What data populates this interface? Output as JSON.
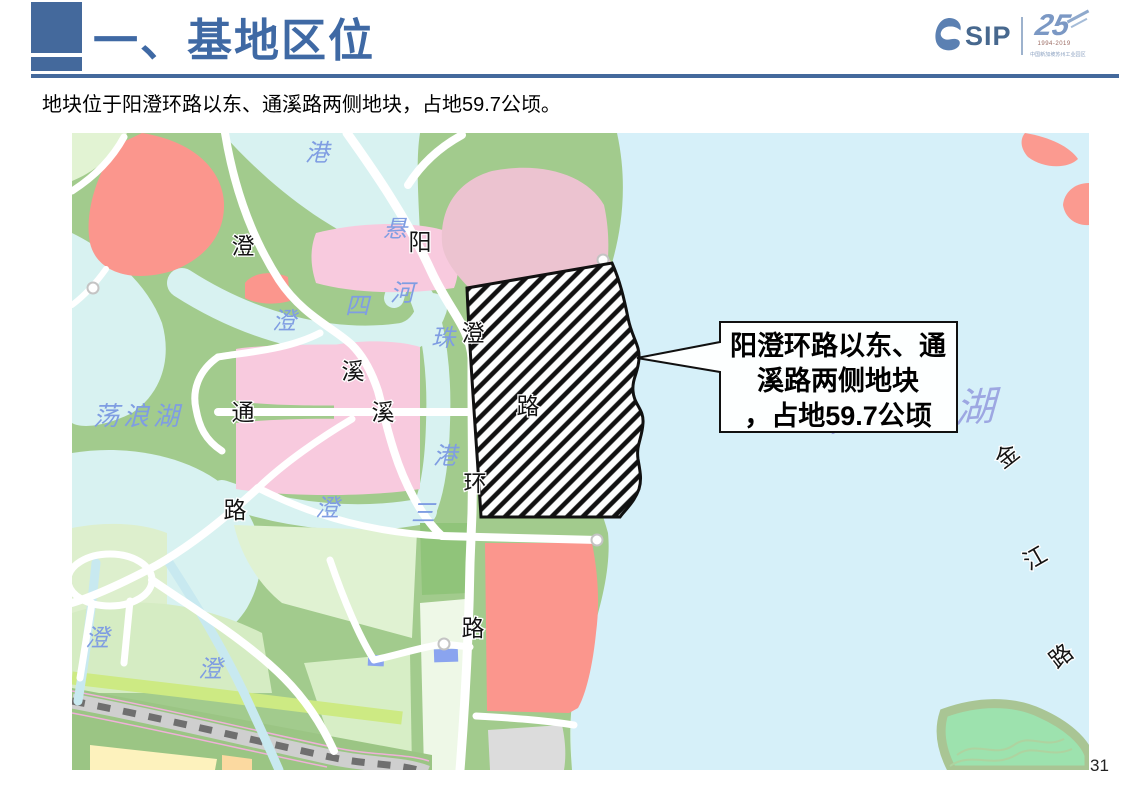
{
  "header": {
    "title": "一、基地区位",
    "logo": {
      "sip": "SIP",
      "anniversary_number": "25",
      "years": "1994-2019",
      "org": "中国新加坡苏州工业园区"
    }
  },
  "subtitle": "地块位于阳澄环路以东、通溪路两侧地块，占地59.7公顷。",
  "callout": {
    "line1": "阳澄环路以东、通",
    "line2": "溪路两侧地块",
    "line3": "，占地59.7公顷"
  },
  "map": {
    "watermark": "阳澄东湖",
    "road_labels": [
      {
        "text": "澄"
      },
      {
        "text": "阳"
      },
      {
        "text": "澄"
      },
      {
        "text": "路"
      },
      {
        "text": "溪"
      },
      {
        "text": "通"
      },
      {
        "text": "溪"
      },
      {
        "text": "路"
      },
      {
        "text": "环"
      },
      {
        "text": "路"
      },
      {
        "text": "金"
      },
      {
        "text": "江"
      },
      {
        "text": "路"
      }
    ],
    "water_labels": [
      {
        "text": "港"
      },
      {
        "text": "悬"
      },
      {
        "text": "河"
      },
      {
        "text": "四"
      },
      {
        "text": "澄"
      },
      {
        "text": "珠"
      },
      {
        "text": "荡浪湖"
      },
      {
        "text": "港"
      },
      {
        "text": "三"
      },
      {
        "text": "澄"
      },
      {
        "text": "澄"
      },
      {
        "text": "澄"
      }
    ],
    "colors": {
      "header_blue": "#44699c",
      "title_blue": "#3f69a4",
      "water": "#d8f2f1",
      "lake_east": "#d6f0f9",
      "land_green": "#a2cb8d",
      "pink_parcel": "#f8cade",
      "dusty_pink_parcel": "#ecc3d0",
      "salmon_parcel": "#fb968d",
      "light_green_parcel": "#e0f2d2",
      "hatch": "#111111"
    }
  },
  "page": {
    "number": "31"
  }
}
